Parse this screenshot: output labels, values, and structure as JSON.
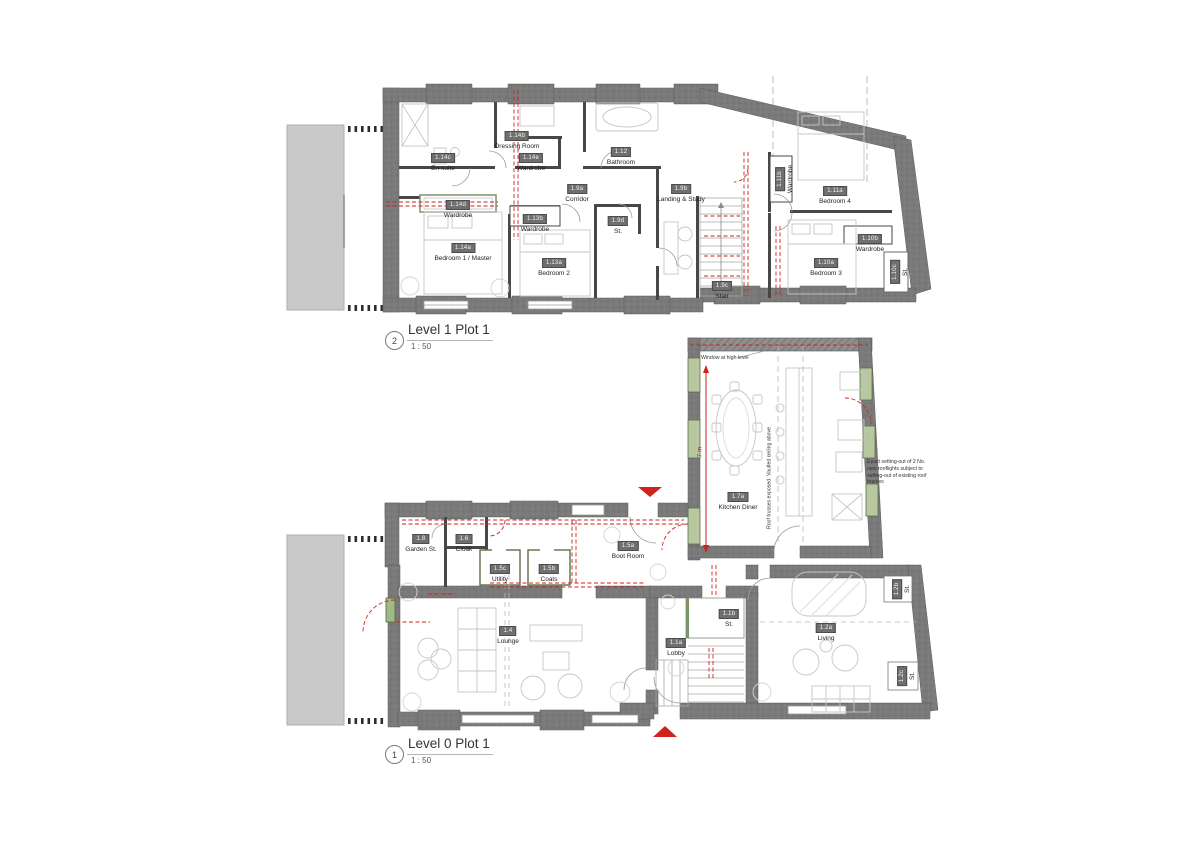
{
  "colors": {
    "wall_gray": "#787878",
    "accent_red": "#cf231c",
    "window_green": "#b7c7a0",
    "neighbour_mass_gray": "#c9c9c9"
  },
  "plans": {
    "level1": {
      "marker": "2",
      "title": "Level 1 Plot 1",
      "scale": "1 : 50",
      "rooms": [
        {
          "tag": "1.14c",
          "name": "En-suite"
        },
        {
          "tag": "1.14b",
          "name": "Dressing Room"
        },
        {
          "tag": "1.14e",
          "name": "Wardrobe"
        },
        {
          "tag": "1.12",
          "name": "Bathroom"
        },
        {
          "tag": "1.9a",
          "name": "Corridor"
        },
        {
          "tag": "1.9b",
          "name": "Landing & Study"
        },
        {
          "tag": "1.14d",
          "name": "Wardrobe"
        },
        {
          "tag": "1.13b",
          "name": "Wardrobe"
        },
        {
          "tag": "1.9d",
          "name": "St."
        },
        {
          "tag": "1.14a",
          "name": "Bedroom 1 / Master"
        },
        {
          "tag": "1.13a",
          "name": "Bedroom 2"
        },
        {
          "tag": "1.11b",
          "name": "Wardrobe"
        },
        {
          "tag": "1.11a",
          "name": "Bedroom 4"
        },
        {
          "tag": "1.10b",
          "name": "Wardrobe"
        },
        {
          "tag": "1.10a",
          "name": "Bedroom 3"
        },
        {
          "tag": "1.9c",
          "name": "Stair"
        },
        {
          "tag": "1.10c",
          "name": "St."
        }
      ]
    },
    "level0": {
      "marker": "1",
      "title": "Level 0 Plot 1",
      "scale": "1 : 50",
      "rooms": [
        {
          "tag": "1.7a",
          "name": "Kitchen Diner"
        },
        {
          "tag": "1.8",
          "name": "Garden St."
        },
        {
          "tag": "1.6",
          "name": "Cloak"
        },
        {
          "tag": "1.5a",
          "name": "Boot Room"
        },
        {
          "tag": "1.5c",
          "name": "Utility"
        },
        {
          "tag": "1.5b",
          "name": "Coats"
        },
        {
          "tag": "1.4",
          "name": "Lounge"
        },
        {
          "tag": "1.1b",
          "name": "St."
        },
        {
          "tag": "1.1a",
          "name": "Lobby"
        },
        {
          "tag": "1.2a",
          "name": "Living"
        },
        {
          "tag": "1.2b",
          "name": "St."
        },
        {
          "tag": "1.2c",
          "name": "St."
        }
      ],
      "notes": {
        "high_window": "Window at high level",
        "rooflights": "Exact setting-out of 2 No. new rooflights subject to setting-out of existing roof trusses",
        "trusses": "Roof trusses exposed. Vaulted ceiling above",
        "kitchen_dim": "7 m"
      }
    }
  }
}
